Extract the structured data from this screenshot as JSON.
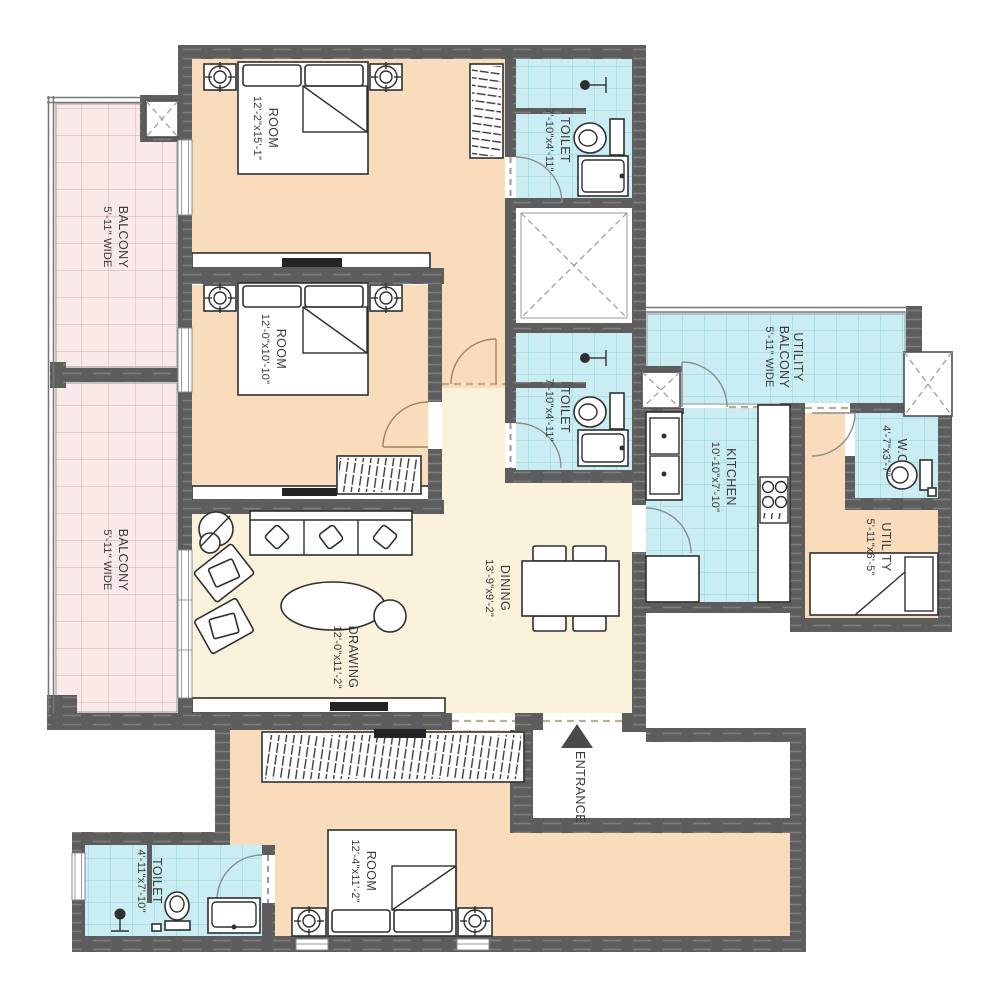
{
  "title": "Apartment floor plan",
  "labels": {
    "room1": {
      "name": "ROOM",
      "dims": "12'-2\"x15'-1\""
    },
    "room2": {
      "name": "ROOM",
      "dims": "12'-0\"x10'-10\""
    },
    "room3": {
      "name": "ROOM",
      "dims": "12'-4\"x11'-2\""
    },
    "toilet1": {
      "name": "TOILET",
      "dims": "7'-10\"x4'-11\""
    },
    "toilet2": {
      "name": "TOILET",
      "dims": "7'-10\"x4'-11\""
    },
    "toilet3": {
      "name": "TOILET",
      "dims": "4'-11\"x7'-10\""
    },
    "balcony_upper": {
      "name": "BALCONY",
      "dims": "5'-11\" WIDE"
    },
    "balcony_lower": {
      "name": "BALCONY",
      "dims": "5'-11\" WIDE"
    },
    "utility_balcony": {
      "line1": "UTILITY",
      "line2": "BALCONY",
      "line3": "5'-11\" WIDE"
    },
    "kitchen": {
      "name": "KITCHEN",
      "dims": "10'-10\"x7'-10\""
    },
    "wc": {
      "name": "W.C",
      "dims": "4'-7\"x3'-7\""
    },
    "utility": {
      "name": "UTILITY",
      "dims": "5'-11\"x6'-5\""
    },
    "dining": {
      "name": "DINING",
      "dims": "13'-9\"x9'-2\""
    },
    "drawing": {
      "name": "DRAWING",
      "dims": "12'-0\"x11'-2\""
    },
    "entrance": {
      "name": "ENTRANCE"
    }
  },
  "colors": {
    "wall": "#5d5d5d",
    "bedroom_floor": "#f8dcbc",
    "living_floor": "#faf2da",
    "wet_area_floor": "#c9edf2",
    "balcony_floor": "#f9e9e9"
  }
}
